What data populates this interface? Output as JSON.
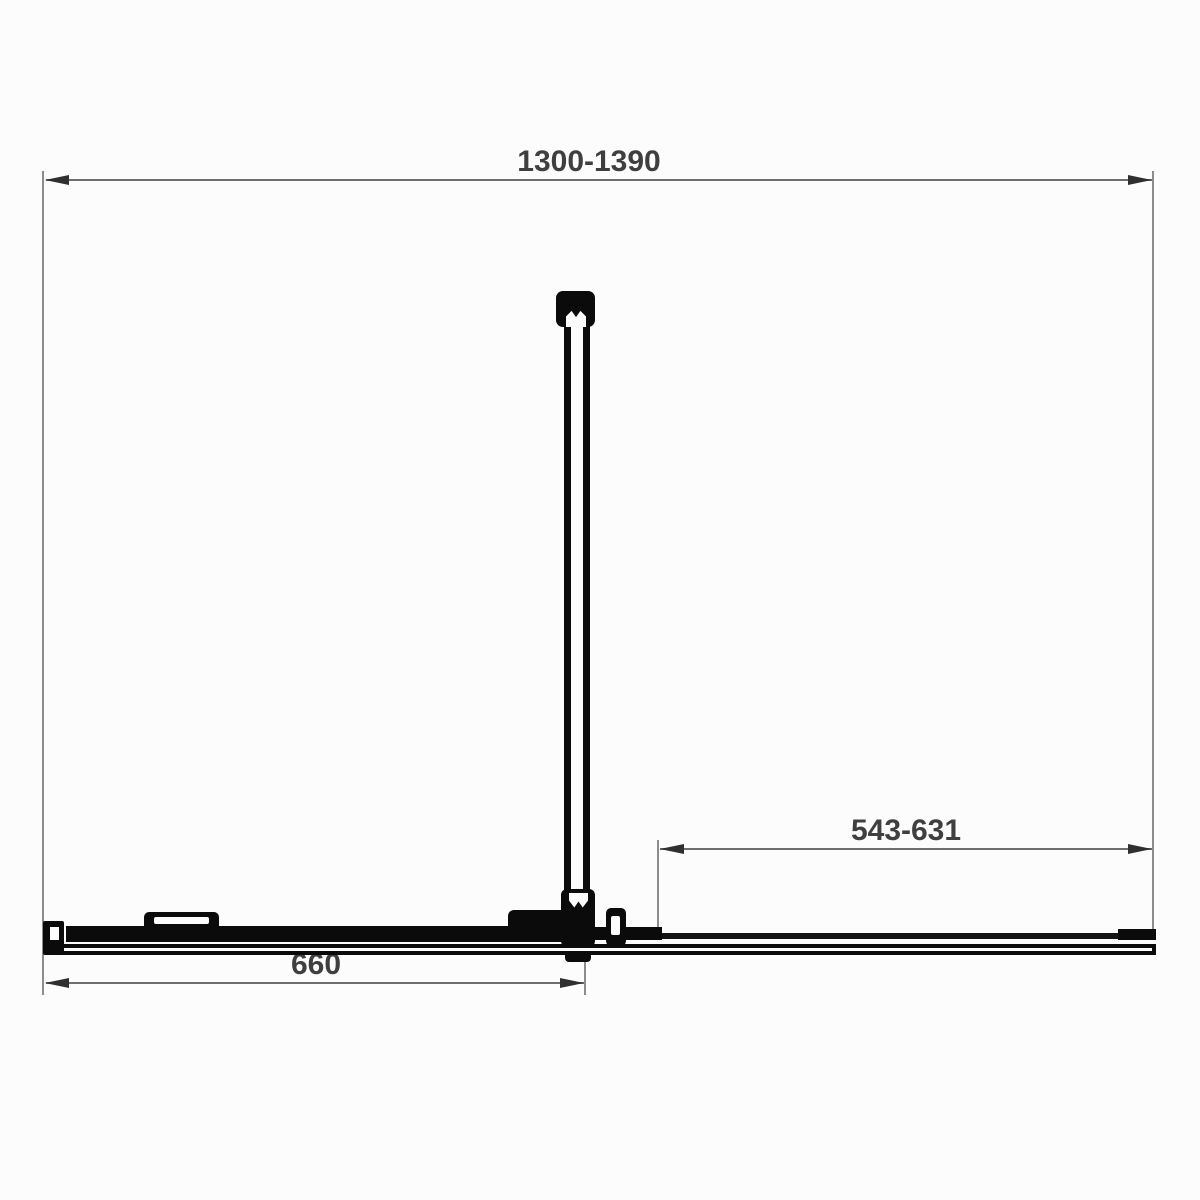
{
  "drawing": {
    "name": "shower-enclosure-plan-view-technical-drawing",
    "dimensions": {
      "overall_width": "1300-1390",
      "opening_width": "543-631",
      "door_width": "660"
    },
    "colors": {
      "background": "#fcfcfc",
      "product_profile": "#0b0b0b",
      "dimension_line": "#6e6e6e",
      "extension_line": "#8c8c8c",
      "arrow": "#2f2f2f",
      "dimension_text": "#3f3f3f"
    }
  }
}
